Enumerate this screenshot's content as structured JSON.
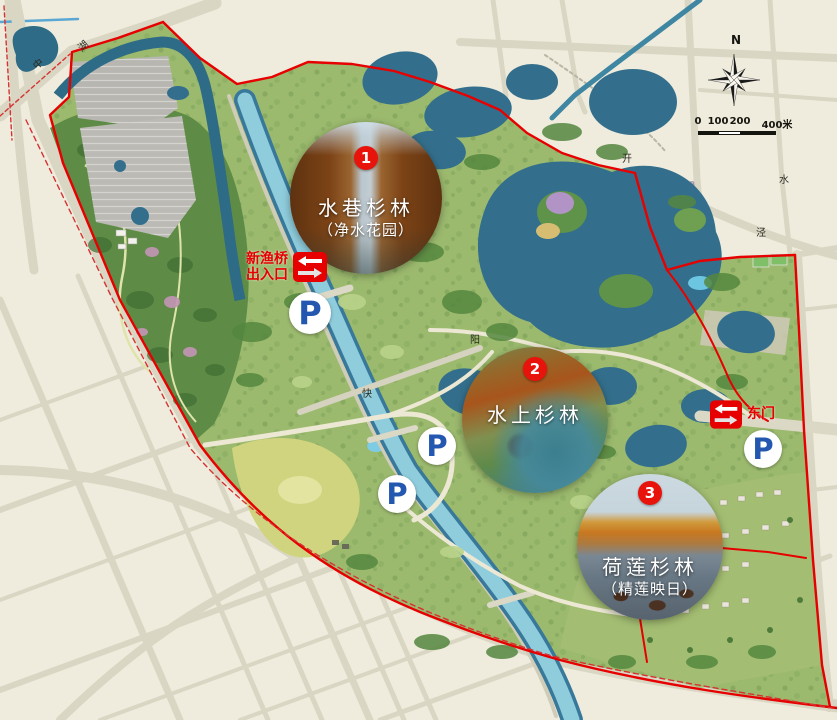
{
  "pois": [
    {
      "badge": "1",
      "name": "水巷杉林",
      "subtitle": "（净水花园）"
    },
    {
      "badge": "2",
      "name": "水上杉林",
      "subtitle": ""
    },
    {
      "badge": "3",
      "name": "荷莲杉林",
      "subtitle": "（精莲映日）"
    }
  ],
  "entrances": [
    {
      "line1": "新渔桥",
      "line2": "出入口"
    },
    {
      "line1": "东门",
      "line2": ""
    }
  ],
  "parking": {
    "label": "P",
    "count": 4
  },
  "compass": {
    "label": "N"
  },
  "scale_bar": {
    "labels": [
      "0",
      "100",
      "200",
      "400米"
    ]
  },
  "road_labels": [
    {
      "text": "中"
    },
    {
      "text": "湖"
    },
    {
      "text": "快"
    },
    {
      "text": "阳"
    },
    {
      "text": "开"
    },
    {
      "text": "泾"
    },
    {
      "text": "水"
    }
  ],
  "colors": {
    "boundary_red": "#e60000",
    "badge_red": "#e8140c",
    "parking_blue": "#2458b0",
    "water_teal": "#336f8c",
    "canal_light": "#8fccdc",
    "park_green": "#9cba6e",
    "urban_cream": "#efecdd"
  }
}
